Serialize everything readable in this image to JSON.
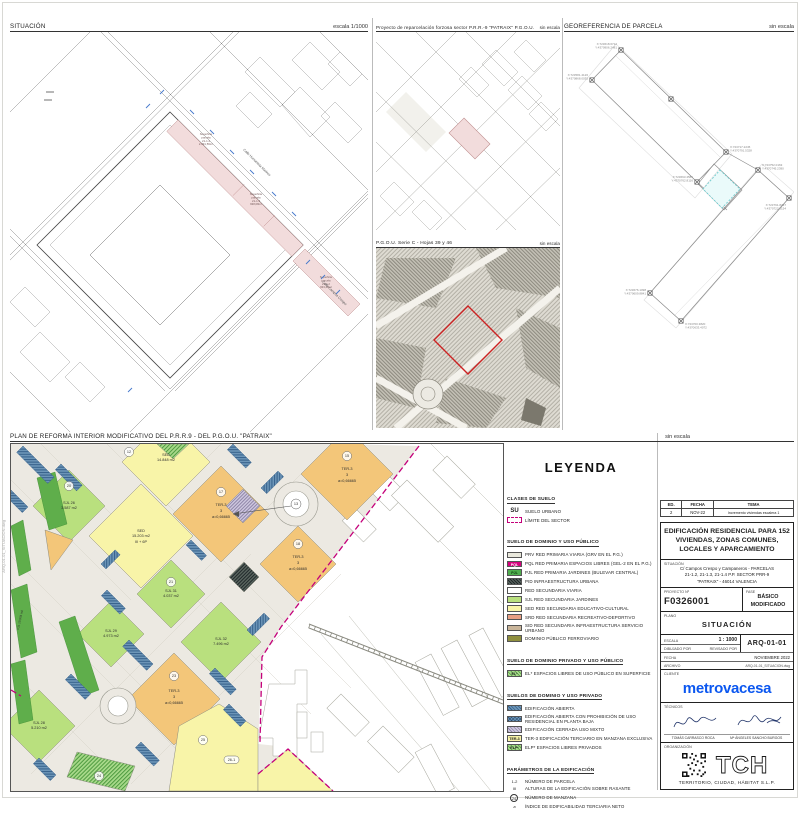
{
  "panels": {
    "situacion": {
      "title": "SITUACIÓN",
      "scale": "escala 1/1000",
      "street_ne": "Calle Humanista Mariner",
      "street_se": "Calle Campos Crespo",
      "parcels": [
        {
          "l1": "Superficie",
          "l2": "parcela",
          "l3": "21-1.4",
          "l4": "2.091,56m²"
        },
        {
          "l1": "Superficie",
          "l2": "parcela",
          "l3": "21-1.3",
          "l4": "938,08m²"
        },
        {
          "l1": "Superficie",
          "l2": "parcela",
          "l3": "21-1.2",
          "l4": "933,48m²"
        }
      ]
    },
    "reparcelacion": {
      "title": "Proyecto de reparcelación forzosa sector P.R.R.-9 \"PATRAIX\" P.G.O.U.",
      "scale": "sin escala"
    },
    "pgou": {
      "title": "P.G.O.U. Serie C - Hojas 39 y 46",
      "scale": "sin escala"
    },
    "georeferencia": {
      "title": "GEOREFERENCIA DE PARCELA",
      "scale": "sin escala",
      "markers": [
        {
          "x": "X:723618.6712",
          "y": "Y:4370906.2481"
        },
        {
          "x": "X:723581.4126",
          "y": "Y:4370868.0035"
        },
        {
          "x": "X:723717.2245",
          "y": "Y:4370791.5328"
        },
        {
          "x": "X:723693.4581",
          "y": "Y:4370762.8116"
        },
        {
          "x": "X:723752.0163",
          "y": "Y:4370745.2390"
        },
        {
          "x": "X:723791.8437",
          "y": "Y:4370722.6154"
        },
        {
          "x": "X:723700.3820",
          "y": "Y:4370633.4072"
        },
        {
          "x": "X:723676.1098",
          "y": "Y:4370609.8841"
        }
      ]
    },
    "plan": {
      "title": "PLAN DE REFORMA INTERIOR MODIFICATIVO DEL P.R.R.9 - DEL P.G.O.U. \"PATRAIX\"",
      "scale": "sin escala",
      "blocks": {
        "sed1": {
          "l1": "SED",
          "l2": "14.848 m2"
        },
        "sed2": {
          "l1": "SED",
          "l2": "15.203 m2",
          "l3": "III + 6P"
        },
        "sjl26": {
          "l1": "SJL 26",
          "l2": "3.587 m2"
        },
        "sjl31": {
          "l1": "SJL 31",
          "l2": "4.037 m2"
        },
        "sjl29": {
          "l1": "SJL 29",
          "l2": "4.973 m2"
        },
        "sjl32": {
          "l1": "SJL 32",
          "l2": "7.496 m2"
        },
        "sjl28": {
          "l1": "SJL 28",
          "l2": "5.210 m2"
        },
        "ter3a": {
          "l1": "TER-3",
          "l2": "3",
          "l3": "a=0,66665"
        },
        "ter3b": {
          "l1": "TER-3",
          "l2": "3",
          "l3": "a=0,66665"
        },
        "ter3c": {
          "l1": "TER-3",
          "l2": "3",
          "l3": "a=0,66665"
        },
        "ter3d": {
          "l1": "TER-3",
          "l2": "3",
          "l3": "a=0,66665"
        },
        "pjl": {
          "l1": "PJL 10.978 m2"
        }
      },
      "manzanas": [
        "12",
        "20",
        "15",
        "17",
        "18",
        "21",
        "13",
        "23",
        "24",
        "25",
        "26-1"
      ]
    }
  },
  "legend": {
    "title": "LEYENDA",
    "clases": {
      "heading": "CLASES DE SUELO",
      "items": [
        {
          "code": "SU",
          "label": "SUELO URBANO"
        },
        {
          "code": "",
          "label": "LÍMITE DEL SECTOR"
        }
      ]
    },
    "publico": {
      "heading": "SUELO DE DOMINIO Y USO PÚBLICO",
      "items": [
        {
          "code": "PRV",
          "label": "PRV RED PRIMARIA VIARIA (GRV EN EL P.G.)"
        },
        {
          "code": "PQL",
          "label": "PQL RED PRIMARIA ESPACIOS LIBRES (GEL-2 EN EL P.G.)"
        },
        {
          "code": "PJL",
          "label": "PJL RED PRIMARIA JARDINES (BULEVAR CENTRAL)"
        },
        {
          "code": "PID",
          "label": "PID INFRAESTRUCTURA URBANA"
        },
        {
          "code": "",
          "label": "RED SECUNDARIA VIARIA"
        },
        {
          "code": "SJL",
          "label": "SJL RED SECUNDARIA JARDINES"
        },
        {
          "code": "SED",
          "label": "SED RED SECUNDARIA EDUCATIVO-CULTURAL"
        },
        {
          "code": "SRD",
          "label": "SRD RED SECUNDARIA RECREATIVO-DEPORTIVO"
        },
        {
          "code": "SID",
          "label": "SID RED SECUNDARIA INFRAESTRUCTURA SERVICIO URBANO"
        },
        {
          "code": "",
          "label": "DOMINIO PÚBLICO FERROVIARIO"
        }
      ]
    },
    "privpub": {
      "heading": "SUELO DE DOMINIO PRIVADO Y USO PÚBLICO",
      "items": [
        {
          "code": "EL*",
          "label": "EL* ESPACIOS LIBRES DE USO PÚBLICO EN SUPERFICIE"
        }
      ]
    },
    "privado": {
      "heading": "SUELOS DE DOMINIO Y USO PRIVADO",
      "items": [
        {
          "code": "",
          "label": "EDIFICACIÓN ABIERTA"
        },
        {
          "code": "",
          "label": "EDIFICACIÓN ABIERTA CON PROHIBICIÓN DE USO RESIDENCIAL EN PLANTA BAJA"
        },
        {
          "code": "",
          "label": "EDIFICACIÓN CERRADA USO MIXTO"
        },
        {
          "code": "TER-3",
          "label": "TER-3 EDIFICACIÓN TERCIARIO EN MANZANA EXCLUSIVA"
        },
        {
          "code": "ELP*",
          "label": "ELP* ESPACIOS LIBRES PRIVADOS"
        }
      ]
    },
    "parametros": {
      "heading": "PARÁMETROS DE LA EDIFICACIÓN",
      "items": [
        {
          "sym": "1-2",
          "label": "NÚMERO DE PARCELA"
        },
        {
          "sym": "III",
          "label": "ALTURAS DE LA EDIFICACIÓN SOBRE RASANTE"
        },
        {
          "sym": "24",
          "label": "NÚMERO DE MANZANA"
        },
        {
          "sym": "a",
          "label": "ÍNDICE DE EDIFICABILIDAD TERCIARIA NETO"
        }
      ]
    }
  },
  "titleblock": {
    "revisions": {
      "headers": [
        "ED.",
        "FECHA",
        "TEMA"
      ],
      "rows": [
        [
          "2",
          "NOV-22",
          "Incremento viviendas escalera 1"
        ]
      ]
    },
    "project_title": "EDIFICACIÓN RESIDENCIAL PARA 152 VIVIENDAS, ZONAS COMUNES, LOCALES Y APARCAMIENTO",
    "situacion_label": "SITUACIÓN",
    "address_l1": "C/ Campos Crespo y Campaneros - PARCELAS",
    "address_l2": "21-1.2, 21-1.3, 21-1.4  P.P. SECTOR PRR-9",
    "address_l3": "\"PATRAIX\" - 46014 VALENCIA",
    "proyecto_label": "PROYECTO Nº",
    "proyecto_num": "F0326001",
    "fase_label": "FASE",
    "fase_l1": "BÁSICO",
    "fase_l2": "MODIFICADO",
    "plano_label": "PLANO",
    "plano_value": "SITUACIÓN",
    "escala_label": "ESCALA",
    "escala_value": "1 : 1000",
    "codigo": "ARQ-01-01",
    "dibujado_label": "DIBUJADO POR",
    "revisado_label": "REVISADO POR",
    "fecha_label": "FECHA",
    "fecha_value": "NOVIEMBRE 2022",
    "archivo_label": "ARCHIVO",
    "archivo_value": "ARQ-01-01_SITUACION.dwg",
    "cliente_label": "CLIENTE",
    "cliente_name": "metrovacesa",
    "tecnicos_label": "TÉCNICOS",
    "tecnico1": "TOMÁS CARRASCO ROCA",
    "tecnico2": "Mª ÁNGELES SANCHO BURGOS",
    "org_label": "ORGANIZACIÓN",
    "org_logo": "TCH",
    "org_name": "TERRITORIO, CIUDAD, HÁBITAT  S.L.P."
  },
  "colors": {
    "magenta_limit": "#c4007a",
    "sed_yellow": "#f8f4a8",
    "ter_orange": "#f3c679",
    "sjl_green": "#b9e07e",
    "pjl_green": "#5fae4b",
    "abierta_blue": "#4e7da6",
    "srd_salmon": "#e89f84",
    "sid_tan": "#c9b59a",
    "ferroviario_olive": "#8f8f3f",
    "parcel_pink": "#f2dcdc",
    "red_outline": "#cc2222",
    "metrovacesa_blue": "#0b57f0"
  }
}
